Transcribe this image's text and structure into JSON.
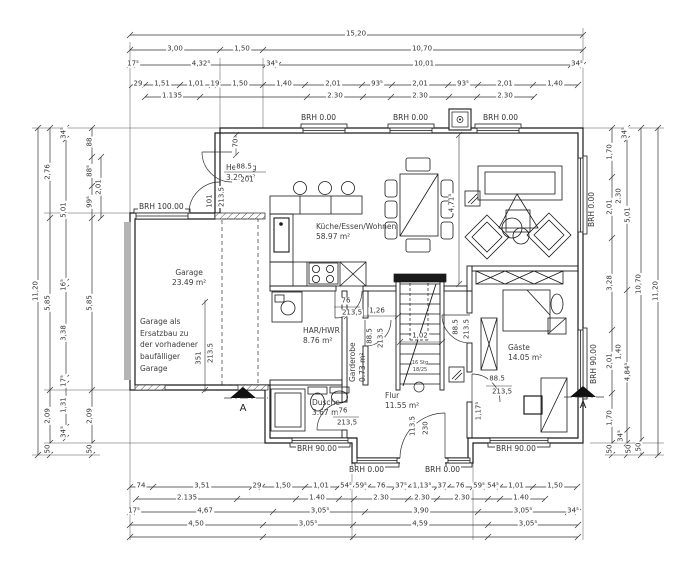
{
  "colors": {
    "line": "#1a1a1a",
    "dimline": "#333333",
    "garage_door_gray": "#b4b4b4",
    "background": "#ffffff"
  },
  "rooms": {
    "heizung": {
      "name": "Heizung",
      "area": "3.29 m²"
    },
    "garage": {
      "name": "Garage",
      "area": "23.49 m²"
    },
    "kueche": {
      "name": "Küche/Essen/Wohnen",
      "area": "58.97 m²"
    },
    "har": {
      "name": "HAR/HWR",
      "area": "8.76 m²"
    },
    "garderobe": {
      "name": "Garderobe",
      "area": "0.73 m²"
    },
    "flur": {
      "name": "Flur",
      "area": "11.55 m²"
    },
    "dusche": {
      "name": "Dusche",
      "area": "3.67 m²"
    },
    "gaeste": {
      "name": "Gäste",
      "area": "14.05 m²"
    }
  },
  "notes": {
    "garage_note_lines": [
      "Garage als",
      "Ersatzbau zu",
      "der vorhadener",
      "baufälliger",
      "Garage"
    ],
    "stairs_label": "16 Stg",
    "stairs_label2": "18/25",
    "section_a_left": "A",
    "section_a_right": "A"
  },
  "brh": {
    "top1": "BRH 0.00",
    "top2": "BRH 0.00",
    "top3": "BRH 0.00",
    "garage": "BRH 100.00",
    "right_living": "BRH 0.00",
    "right_gaeste": "BRH 90.00",
    "bottom_left": "BRH 90.00",
    "bottom_mid1": "BRH 0.00",
    "bottom_mid2": "BRH 0.00",
    "bottom_right": "BRH 90.00"
  },
  "dims": {
    "top": {
      "total": "15,20",
      "row2": [
        "3,00",
        "1,50",
        "10,70"
      ],
      "row3": [
        "17⁵",
        "4,32⁵",
        "34⁵",
        "10,01",
        "34⁵"
      ],
      "row4": [
        "29",
        "1,51",
        "1,01",
        "19",
        "1,50",
        "1,40",
        "2,01",
        "93⁵",
        "2,01",
        "93⁵",
        "2,01",
        "1,40"
      ],
      "row5": [
        "1.135",
        "2.30",
        "2.30",
        "2.30"
      ]
    },
    "bottom": {
      "row1": [
        "74",
        "3,51",
        "29",
        "1,50",
        "1,01",
        "54⁵",
        "59⁵",
        "76",
        "37⁵",
        "1,13⁵",
        "37",
        "76",
        "59⁵",
        "54⁵",
        "1,01",
        "1,50"
      ],
      "row2": [
        "2.135",
        "1.40",
        "2.30",
        "2.30",
        "2.30",
        "1.40"
      ],
      "row3": [
        "17⁵",
        "4,67",
        "3,05⁵",
        "3,90",
        "3,05⁵",
        "34⁵"
      ],
      "row4": [
        "4,50",
        "3,05⁵",
        "4,59",
        "3,05⁵"
      ]
    },
    "left": {
      "outer": "11,20",
      "chain2": [
        "2,76",
        "5,85",
        "2,09",
        "50"
      ],
      "chain3": [
        "34⁵",
        "5,01",
        "16⁵",
        "3,38",
        "17⁵",
        "1,31",
        "34⁵"
      ],
      "chain4": [
        "88",
        "88⁵",
        "99⁵",
        "5,85",
        "2,09",
        "50"
      ],
      "extra": "2,01"
    },
    "right": {
      "outer": "11,20",
      "chain1": [
        "1,70",
        "2,01",
        "3,28",
        "2,01",
        "1,70",
        "50"
      ],
      "chain2": [
        "34⁵",
        "2.30",
        "5,01",
        "1,40",
        "4,84⁵",
        "34⁵",
        "50"
      ],
      "chain3": [
        "10,70",
        "50"
      ]
    },
    "interior": [
      "70",
      "88.5",
      "201",
      "101",
      "213.5",
      "351",
      "213.5",
      "76",
      "213,5",
      "1,26",
      "88.5",
      "213.5",
      "1,02",
      "88.5",
      "213.5",
      "88.5",
      "213,5",
      "1,17⁵",
      "113.5",
      "230",
      "76",
      "213,5",
      "4,71⁵"
    ]
  }
}
